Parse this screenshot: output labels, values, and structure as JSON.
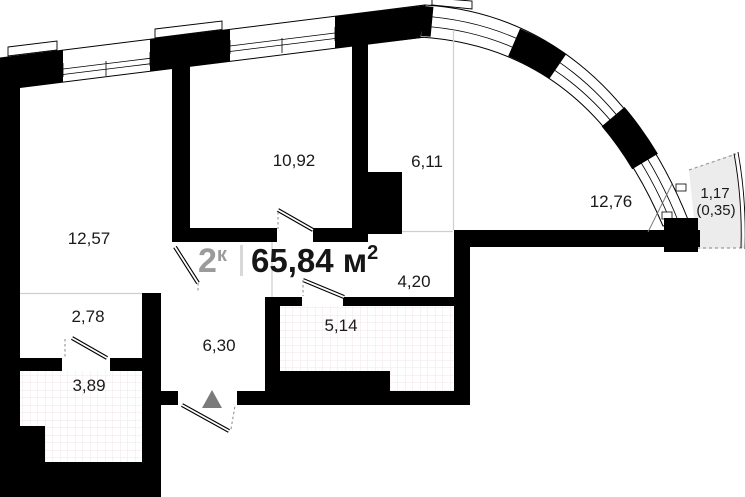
{
  "title": {
    "rooms_num": "2",
    "rooms_suffix": "к",
    "divider": "|",
    "area": "65,84 м",
    "area_sup": "2"
  },
  "rooms": {
    "r1257": "12,57",
    "r1092": "10,92",
    "r611": "6,11",
    "r1276": "12,76",
    "r420": "4,20",
    "r278": "2,78",
    "r630": "6,30",
    "r514": "5,14",
    "r389": "3,89",
    "balcony_full": "1,17",
    "balcony_reduced": "(0,35)"
  },
  "colors": {
    "wall": "#000000",
    "zone_line": "#cfcfcf",
    "title_gray": "#9b9b9b",
    "title_dark": "#161616",
    "balcony_fill": "#ececec",
    "tile_line": "#f0e6eb",
    "entrance_marker": "#7b7b7b"
  }
}
